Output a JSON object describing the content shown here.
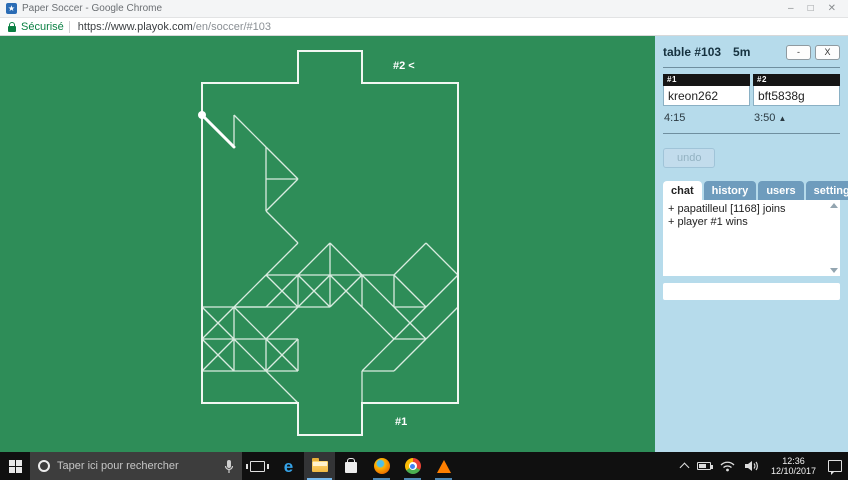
{
  "browser": {
    "title": "Paper Soccer - Google Chrome",
    "favicon_glyph": "★",
    "security_label": "Sécurisé",
    "url_host": "https://www.playok.com",
    "url_path": "/en/soccer/#103",
    "window_controls": {
      "minimize": "–",
      "restore": "□",
      "close": "✕"
    }
  },
  "board": {
    "bg_color": "#2e8d58",
    "outline_color": "#f1f7f2",
    "segment_color": "#d9ece0",
    "origin": [
      202,
      47
    ],
    "cell": 32,
    "cols": 8,
    "rows": 10,
    "goal_cols": [
      3,
      5
    ],
    "ball": [
      0,
      1
    ],
    "last_move": [
      [
        0,
        1
      ],
      [
        1,
        2
      ]
    ],
    "labels": [
      {
        "text": "#2 <",
        "x": 393,
        "y": 33
      },
      {
        "text": "#1",
        "x": 395,
        "y": 389
      }
    ],
    "segments": [
      [
        1,
        1,
        1,
        2
      ],
      [
        1,
        1,
        2,
        2
      ],
      [
        2,
        2,
        3,
        3
      ],
      [
        3,
        3,
        2,
        4
      ],
      [
        2,
        2,
        2,
        3
      ],
      [
        2,
        3,
        2,
        4
      ],
      [
        2,
        3,
        3,
        3
      ],
      [
        2,
        4,
        3,
        5
      ],
      [
        3,
        5,
        2,
        6
      ],
      [
        2,
        6,
        6,
        6
      ],
      [
        4,
        5,
        3,
        6
      ],
      [
        4,
        5,
        5,
        6
      ],
      [
        4,
        5,
        4,
        6
      ],
      [
        4,
        6,
        4,
        7
      ],
      [
        2,
        6,
        1,
        7
      ],
      [
        1,
        7,
        2,
        7
      ],
      [
        2,
        6,
        3,
        7
      ],
      [
        3,
        6,
        2,
        7
      ],
      [
        3,
        6,
        4,
        7
      ],
      [
        4,
        6,
        3,
        7
      ],
      [
        4,
        6,
        5,
        7
      ],
      [
        5,
        6,
        4,
        7
      ],
      [
        5,
        6,
        6,
        7
      ],
      [
        3,
        6,
        3,
        7
      ],
      [
        5,
        6,
        5,
        7
      ],
      [
        0,
        7,
        4,
        7
      ],
      [
        6,
        6,
        6,
        7
      ],
      [
        6,
        7,
        7,
        7
      ],
      [
        7,
        5,
        6,
        6
      ],
      [
        7,
        5,
        8,
        6
      ],
      [
        6,
        6,
        7,
        7
      ],
      [
        7,
        7,
        8,
        6
      ],
      [
        6,
        7,
        7,
        8
      ],
      [
        7,
        8,
        8,
        7
      ],
      [
        5,
        7,
        6,
        8
      ],
      [
        6,
        8,
        7,
        7
      ],
      [
        6,
        8,
        7,
        8
      ],
      [
        6,
        8,
        5,
        9
      ],
      [
        5,
        9,
        6,
        9
      ],
      [
        6,
        9,
        7,
        8
      ],
      [
        5,
        9,
        5,
        10
      ],
      [
        0,
        7,
        1,
        8
      ],
      [
        1,
        7,
        0,
        8
      ],
      [
        0,
        8,
        1,
        9
      ],
      [
        1,
        8,
        0,
        9
      ],
      [
        1,
        7,
        1,
        8
      ],
      [
        1,
        8,
        1,
        9
      ],
      [
        1,
        7,
        2,
        8
      ],
      [
        2,
        8,
        3,
        7
      ],
      [
        0,
        8,
        3,
        8
      ],
      [
        0,
        9,
        2,
        9
      ],
      [
        2,
        8,
        2,
        9
      ],
      [
        3,
        8,
        3,
        9
      ],
      [
        2,
        8,
        3,
        9
      ],
      [
        3,
        8,
        2,
        9
      ],
      [
        2,
        9,
        3,
        9
      ],
      [
        1,
        8,
        2,
        9
      ],
      [
        2,
        9,
        3,
        10
      ]
    ]
  },
  "sidebar": {
    "header": {
      "title": "table #103",
      "time_control": "5m",
      "minimize": "-",
      "close": "X"
    },
    "players": [
      {
        "num": "#1",
        "name": "kreon262",
        "clock": "4:15",
        "turn_marker": ""
      },
      {
        "num": "#2",
        "name": "bft5838g",
        "clock": "3:50",
        "turn_marker": "▲"
      }
    ],
    "undo_label": "undo",
    "tabs": [
      "chat",
      "history",
      "users",
      "settings"
    ],
    "active_tab": "chat",
    "chat": {
      "messages": [
        "+ papatilleul [1168] joins",
        "+ player #1 wins"
      ],
      "input_value": ""
    }
  },
  "taskbar": {
    "search_placeholder": "Taper ici pour rechercher",
    "clock": {
      "time": "12:36",
      "date": "12/10/2017"
    },
    "icons": [
      "start",
      "cortana-ring",
      "microphone",
      "task-view",
      "edge",
      "file-explorer",
      "store",
      "firefox",
      "chrome",
      "vlc",
      "tray-expand",
      "battery",
      "wifi",
      "volume",
      "action-center"
    ]
  }
}
